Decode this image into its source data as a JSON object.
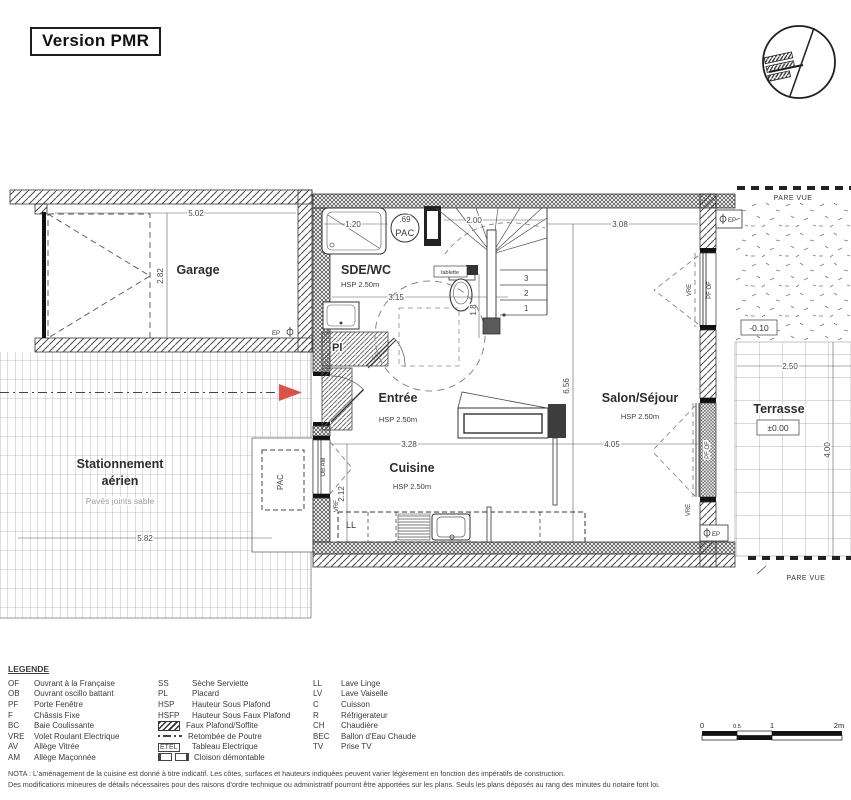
{
  "header": {
    "title": "Version PMR"
  },
  "plan": {
    "garage": {
      "label": "Garage",
      "dim_w": "5.02",
      "dim_h": "2.82",
      "ep": "EP"
    },
    "sdewc": {
      "label": "SDE/WC",
      "hsp": "HSP 2.50m",
      "shower_dim": "1.20",
      "pac_dim": ".69",
      "pac": "PAC",
      "tablette": "tablette",
      "dim_w": "3.15",
      "dim_wc": "1.8"
    },
    "stairs": {
      "dim": "2.00",
      "steps": [
        "1",
        "2",
        "3"
      ]
    },
    "entree": {
      "label": "Entrée",
      "hsp": "HSP 2.50m",
      "placard": "Pl",
      "door_dim": "0.90"
    },
    "etel": {
      "label": "ETEL"
    },
    "cuisine": {
      "label": "Cuisine",
      "hsp": "HSP 2.50m",
      "dim_w": "3.28",
      "dim_h": "2.12",
      "ll": "LL"
    },
    "salon": {
      "label": "Salon/Séjour",
      "hsp": "HSP 2.50m",
      "dim_top": "3.08",
      "dim_h": "6.56",
      "dim_w": "4.05"
    },
    "windows": {
      "pf_of": "PF OF",
      "vre": "VRE",
      "ob_am": "OB AM"
    },
    "terrasse": {
      "label": "Terrasse",
      "level": "±0.00",
      "level_path": "-0.10",
      "dim_w": "2.50",
      "dim_h": "4.00",
      "pare_vue": "PARE VUE",
      "ep": "EP"
    },
    "stationnement": {
      "label_line1": "Stationnement",
      "label_line2": "aérien",
      "surface": "Pavés joints sable",
      "dim": "5.82",
      "pac": "PAC"
    }
  },
  "scalebar": {
    "t0": "0",
    "t05": "0.5",
    "t1": "1",
    "t2": "2m"
  },
  "legend": {
    "heading": "LEGENDE",
    "col1": [
      {
        "abbr": "OF",
        "label": "Ouvrant à la Française"
      },
      {
        "abbr": "OB",
        "label": "Ouvrant oscillo battant"
      },
      {
        "abbr": "PF",
        "label": "Porte Fenêtre"
      },
      {
        "abbr": "F",
        "label": "Châssis Fixe"
      },
      {
        "abbr": "BC",
        "label": "Baie Coulissante"
      },
      {
        "abbr": "VRE",
        "label": "Volet Roulant Electrique"
      },
      {
        "abbr": "AV",
        "label": "Allège Vitrée"
      },
      {
        "abbr": "AM",
        "label": "Allège Maçonnée"
      }
    ],
    "col2": [
      {
        "abbr": "SS",
        "label": "Sèche Serviette"
      },
      {
        "abbr": "PL",
        "label": "Placard"
      },
      {
        "abbr": "HSP",
        "label": "Hauteur Sous Plafond"
      },
      {
        "abbr": "HSFP",
        "label": "Hauteur Sous Faux Plafond"
      },
      {
        "abbr": "",
        "label": "Faux Plafond/Soffite"
      },
      {
        "abbr": "",
        "label": "Retombée de Poutre"
      },
      {
        "abbr": "ETEL",
        "label": "Tableau Electrique"
      },
      {
        "abbr": "",
        "label": "Cloison démontable"
      }
    ],
    "col3": [
      {
        "abbr": "LL",
        "label": "Lave Linge"
      },
      {
        "abbr": "LV",
        "label": "Lave Vaiselle"
      },
      {
        "abbr": "C",
        "label": "Cuisson"
      },
      {
        "abbr": "R",
        "label": "Réfrigerateur"
      },
      {
        "abbr": "CH",
        "label": "Chaudière"
      },
      {
        "abbr": "BEC",
        "label": "Ballon d'Eau Chaude"
      },
      {
        "abbr": "TV",
        "label": "Prise TV"
      }
    ]
  },
  "nota": {
    "line1": "NOTA : L'aménagement de la cuisine est donné à titre indicatif. Les côtes, surfaces et hauteurs indiquées peuvent varier légèrement en fonction des impératifs de construction.",
    "line2": "Des modifications mineures de détails nécessaires pour des raisons d'ordre technique ou administratif pourront être apportées sur les plans. Seuls les plans déposés au rang des minutes du notaire font loi."
  },
  "colors": {
    "arrow_red": "#dd5147",
    "ink": "#3a3a3a"
  }
}
